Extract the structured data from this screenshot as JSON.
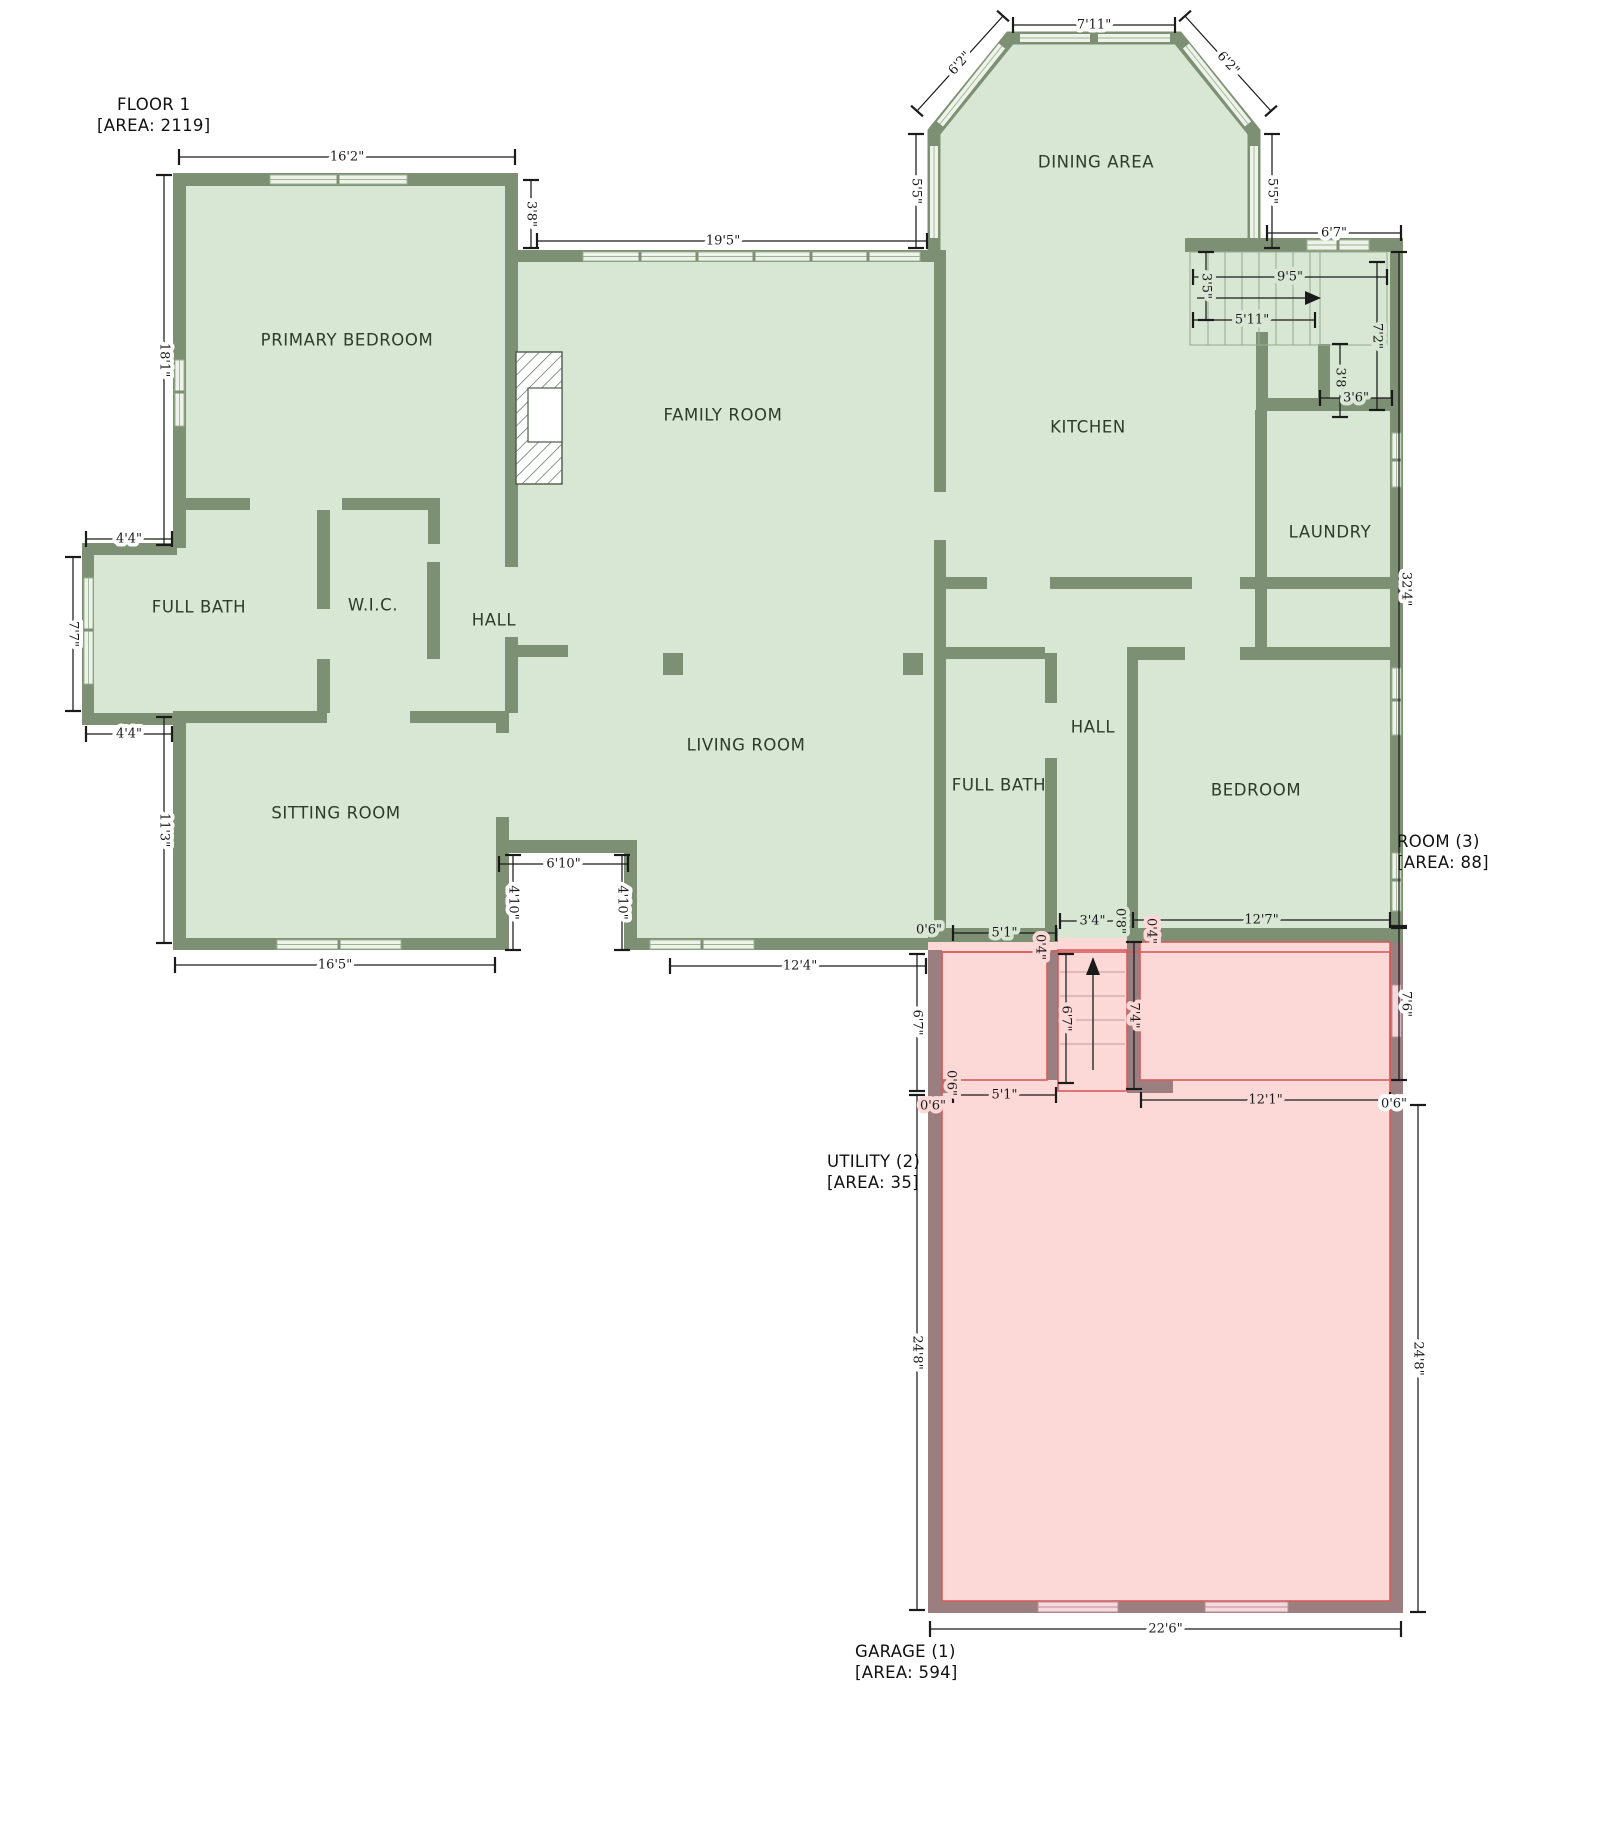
{
  "labels": {
    "floor": {
      "line1": "FLOOR 1",
      "line2": "[AREA: 2119]"
    },
    "room3": {
      "line1": "ROOM (3)",
      "line2": "[AREA: 88]"
    },
    "utility": {
      "line1": "UTILITY (2)",
      "line2": "[AREA: 35]"
    },
    "garage": {
      "line1": "GARAGE (1)",
      "line2": "[AREA: 594]"
    }
  },
  "colors": {
    "background": "#ffffff",
    "floor_green": "#d7e7d3",
    "floor_pink": "#fcd9d7",
    "wall_green": "#7d9073",
    "wall_garage": "#9b7f80",
    "outline_red": "#d65c5c",
    "window_fill": "#eef3ea",
    "window_frame": "#9db295",
    "garage_window_fill": "#f6d7dc",
    "garage_window_frame": "#bb8f96",
    "dim_color": "#1a1a1a",
    "room_text": "#2d3b2a",
    "label_text": "#111111",
    "tread_green": "#9aae92",
    "tread_pink": "#c49a9c",
    "hatch": "#5a6a58"
  },
  "rooms": [
    {
      "t": "PRIMARY BEDROOM",
      "x": 347,
      "y": 340
    },
    {
      "t": "FAMILY ROOM",
      "x": 723,
      "y": 415
    },
    {
      "t": "DINING AREA",
      "x": 1096,
      "y": 162
    },
    {
      "t": "KITCHEN",
      "x": 1088,
      "y": 427
    },
    {
      "t": "LAUNDRY",
      "x": 1330,
      "y": 532
    },
    {
      "t": "FULL BATH",
      "x": 199,
      "y": 607
    },
    {
      "t": "W.I.C.",
      "x": 373,
      "y": 605
    },
    {
      "t": "HALL",
      "x": 494,
      "y": 620
    },
    {
      "t": "SITTING ROOM",
      "x": 336,
      "y": 813
    },
    {
      "t": "LIVING ROOM",
      "x": 746,
      "y": 745
    },
    {
      "t": "FULL BATH",
      "x": 999,
      "y": 785
    },
    {
      "t": "HALL",
      "x": 1093,
      "y": 727
    },
    {
      "t": "BEDROOM",
      "x": 1256,
      "y": 790
    }
  ],
  "dims": [
    {
      "t": "16'2\"",
      "line": [
        179,
        157,
        515,
        157
      ],
      "halo": "w"
    },
    {
      "t": "3'8\"",
      "line": [
        531,
        180,
        531,
        248
      ],
      "rot": 90,
      "halo": "w"
    },
    {
      "t": "19'5\"",
      "line": [
        537,
        241,
        927,
        241
      ],
      "halo": "w",
      "tx": 723
    },
    {
      "t": "7'11\"",
      "line": [
        1013,
        25,
        1175,
        25
      ],
      "halo": "w"
    },
    {
      "t": "6'2\"",
      "line": [
        917,
        111,
        1003,
        16
      ],
      "rot": -48,
      "halo": "w"
    },
    {
      "t": "6'2\"",
      "line": [
        1185,
        16,
        1271,
        111
      ],
      "rot": 48,
      "halo": "w"
    },
    {
      "t": "5'5\"",
      "line": [
        916,
        134,
        916,
        248
      ],
      "rot": 90,
      "halo": "w"
    },
    {
      "t": "5'5\"",
      "line": [
        1272,
        134,
        1272,
        248
      ],
      "rot": 90,
      "halo": "w"
    },
    {
      "t": "6'7\"",
      "line": [
        1267,
        233,
        1401,
        233
      ],
      "halo": "w"
    },
    {
      "t": "18'1\"",
      "line": [
        164,
        175,
        164,
        545
      ],
      "rot": 90,
      "halo": "w"
    },
    {
      "t": "4'4\"",
      "line": [
        86,
        539,
        172,
        539
      ],
      "halo": "w"
    },
    {
      "t": "7'7\"",
      "line": [
        73,
        557,
        73,
        711
      ],
      "rot": 90,
      "halo": "w"
    },
    {
      "t": "4'4\"",
      "line": [
        86,
        734,
        172,
        734
      ],
      "halo": "w"
    },
    {
      "t": "11'3\"",
      "line": [
        164,
        717,
        164,
        943
      ],
      "rot": 90,
      "halo": "w"
    },
    {
      "t": "16'5\"",
      "line": [
        175,
        965,
        495,
        965
      ],
      "halo": "w"
    },
    {
      "t": "12'4\"",
      "line": [
        670,
        966,
        926,
        966
      ],
      "halo": "w",
      "tx": 800
    },
    {
      "t": "6'10\"",
      "line": [
        499,
        864,
        628,
        864
      ],
      "halo": "w"
    },
    {
      "t": "4'10\"",
      "line": [
        513,
        855,
        513,
        950
      ],
      "rot": 90,
      "halo": "w"
    },
    {
      "t": "4'10\"",
      "line": [
        622,
        855,
        622,
        950
      ],
      "rot": 90,
      "halo": "w"
    },
    {
      "t": "22'6\"",
      "line": [
        930,
        1629,
        1401,
        1629
      ],
      "halo": "w"
    },
    {
      "t": "6'7\"",
      "line": [
        917,
        954,
        917,
        1091
      ],
      "rot": 90,
      "halo": "w"
    },
    {
      "t": "24'8\"",
      "line": [
        917,
        1095,
        917,
        1610
      ],
      "rot": 90,
      "halo": "w"
    },
    {
      "t": "32'4\"",
      "line": [
        1399,
        252,
        1399,
        926
      ],
      "rot": 90,
      "halo": "w",
      "tx": 1406
    },
    {
      "t": "7'6\"",
      "line": [
        1399,
        928,
        1399,
        1080
      ],
      "rot": 90,
      "halo": "w",
      "tx": 1406
    },
    {
      "t": "24'8\"",
      "line": [
        1418,
        1105,
        1418,
        1612
      ],
      "rot": 90,
      "halo": "w"
    },
    {
      "t": "12'7\"",
      "line": [
        1133,
        920,
        1390,
        920
      ],
      "halo": "g"
    },
    {
      "t": "12'1\"",
      "line": [
        1141,
        1100,
        1390,
        1100
      ],
      "halo": "p"
    },
    {
      "t": "0'6\"",
      "tx": 1394,
      "ty": 1104,
      "halo": "w"
    },
    {
      "t": "5'1\"",
      "line": [
        953,
        933,
        1056,
        933
      ],
      "halo": "g"
    },
    {
      "t": "0'6\"",
      "tx": 929,
      "ty": 930,
      "halo": "g"
    },
    {
      "t": "3'4\"",
      "line": [
        1060,
        921,
        1125,
        921
      ],
      "halo": "g"
    },
    {
      "t": "0'8\"",
      "tx": 1120,
      "ty": 921,
      "rot": 90,
      "halo": "g"
    },
    {
      "t": "0'4\"",
      "tx": 1151,
      "ty": 931,
      "rot": 90,
      "halo": "p"
    },
    {
      "t": "0'4\"",
      "tx": 1040,
      "ty": 947,
      "rot": 90,
      "halo": "p"
    },
    {
      "t": "5'1\"",
      "line": [
        953,
        1095,
        1056,
        1095
      ],
      "halo": "p"
    },
    {
      "t": "0'6\"",
      "tx": 933,
      "ty": 1106,
      "halo": "p"
    },
    {
      "t": "0'6\"",
      "tx": 951,
      "ty": 1083,
      "rot": 90,
      "halo": "p"
    },
    {
      "t": "6'7\"",
      "line": [
        1066,
        954,
        1066,
        1083
      ],
      "rot": 90,
      "halo": "p"
    },
    {
      "t": "7'4\"",
      "line": [
        1134,
        942,
        1134,
        1089
      ],
      "rot": 90,
      "halo": "p"
    },
    {
      "t": "9'5\"",
      "line": [
        1193,
        277,
        1387,
        277
      ],
      "halo": "g",
      "tx": 1290
    },
    {
      "t": "3'5\"",
      "line": [
        1206,
        252,
        1206,
        320
      ],
      "rot": 90,
      "halo": "g"
    },
    {
      "t": "5'11\"",
      "line": [
        1193,
        320,
        1315,
        320
      ],
      "halo": "g",
      "tx": 1252
    },
    {
      "t": "3'8\"",
      "line": [
        1340,
        344,
        1340,
        417
      ],
      "rot": 90,
      "halo": "g"
    },
    {
      "t": "3'6\"",
      "line": [
        1320,
        398,
        1392,
        398
      ],
      "halo": "g"
    },
    {
      "t": "7'2\"",
      "line": [
        1377,
        262,
        1377,
        410
      ],
      "rot": 90,
      "halo": "g"
    }
  ]
}
